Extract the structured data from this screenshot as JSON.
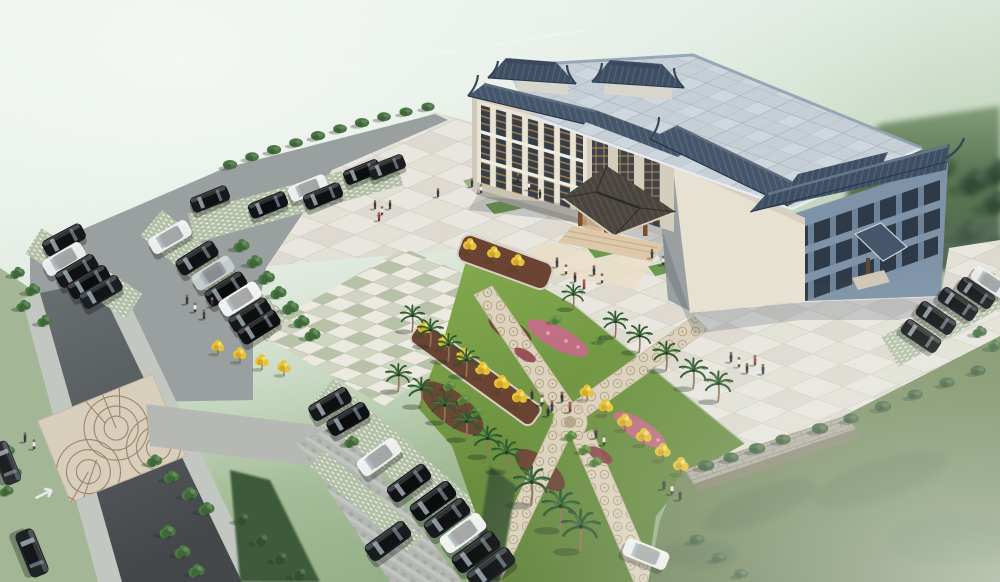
{
  "scene": {
    "type": "architectural-aerial-rendering",
    "subject": "chinese-style-civic-building-with-plaza-gardens-and-parking",
    "view": "birds-eye-perspective",
    "atmosphere": "foggy-top-left-and-bottom-right"
  },
  "palette": {
    "fog": "#f0f5f0",
    "grass_bg": "#a9bf9c",
    "tree_dark": "#3c5a40",
    "plaza": "#e9e6e0",
    "plaza_line": "#d2cec6",
    "plaza_dark": "#ded9d1",
    "checker_green": "#b7c2a8",
    "checker_light": "#ece9e0",
    "asphalt": "#9aa0a0",
    "aisle": "#b5b8b2",
    "road": "#565c5e",
    "sidewalk": "#c3c7c1",
    "stall": "#b3bfa6",
    "stall_dot": "#eef0e7",
    "lawn": "#7e9465",
    "garden_lawn": "#7aa446",
    "mulch": "#6a4333",
    "path": "#dcd2bd",
    "path_motif": "#b5a384",
    "roof_tile": "#46566a",
    "roof_ridge": "#6e7e92",
    "roof_flat": "#c6cfd6",
    "roof_line": "#a9b4bd",
    "wall": "#e9e3d4",
    "wall_shade": "#d4ccbc",
    "wall_blue": "#7e93a7",
    "window_dark": "#313b46",
    "lattice": "#c08845",
    "canopy": "#4a463f",
    "canopy_trim": "#d8cdb8",
    "wood": "#7c4e28",
    "glow": "#c98f4f",
    "step": "#ddc9a9",
    "stone_wall": "#b2ada2",
    "flower_pink": "#c96a8a",
    "ytree": "#e6c235",
    "palm": "#2d5830",
    "shrub": "#4a7444",
    "shadow": "#2c3e55"
  },
  "building": {
    "style": "traditional-chinese-roofs-on-modern-block",
    "floors": 3,
    "rooftop_pavilions": 2,
    "entrance_canopy": "hip-roof-porte-cochere",
    "secondary_canopy": 1
  },
  "counts": {
    "cars": 36,
    "palms": 19,
    "people": 33,
    "yellow_trees": 19
  },
  "darktrees": [
    [
      872,
      175,
      0,
      1.8
    ],
    [
      905,
      160,
      0,
      2.0
    ],
    [
      940,
      170,
      0,
      2.1
    ],
    [
      975,
      185,
      0,
      2.0
    ],
    [
      998,
      205,
      0,
      1.9
    ],
    [
      890,
      215,
      0,
      1.8
    ],
    [
      930,
      225,
      0,
      1.9
    ],
    [
      970,
      235,
      0,
      1.8
    ],
    [
      996,
      250,
      0,
      1.7
    ],
    [
      858,
      240,
      0,
      1.5
    ],
    [
      1000,
      175,
      0,
      2.0
    ]
  ],
  "trees": [
    [
      242,
      247,
      0,
      1.0
    ],
    [
      255,
      263,
      0,
      1.0
    ],
    [
      267,
      279,
      0,
      1.05
    ],
    [
      279,
      294,
      0,
      1.0
    ],
    [
      291,
      309,
      0,
      1.05
    ],
    [
      302,
      323,
      0,
      1.0
    ],
    [
      313,
      336,
      0,
      1.0
    ],
    [
      18,
      274,
      0,
      0.9
    ],
    [
      33,
      291,
      0,
      0.95
    ],
    [
      24,
      307,
      0,
      0.9
    ],
    [
      45,
      322,
      0,
      0.9
    ],
    [
      8,
      452,
      0,
      0.9
    ],
    [
      15,
      474,
      0,
      0.9
    ],
    [
      7,
      492,
      0,
      0.85
    ],
    [
      155,
      462,
      0,
      0.95
    ],
    [
      172,
      478,
      0,
      0.95
    ],
    [
      190,
      495,
      0,
      1.0
    ],
    [
      207,
      510,
      0,
      1.0
    ],
    [
      168,
      533,
      0,
      1.0
    ],
    [
      183,
      553,
      0,
      1.0
    ],
    [
      197,
      572,
      0,
      1.0
    ],
    [
      243,
      520,
      0,
      0.95,
      "#3f5f3a"
    ],
    [
      262,
      541,
      0,
      1.0,
      "#3f5f3a"
    ],
    [
      281,
      559,
      0,
      1.0,
      "#3f5f3a"
    ],
    [
      300,
      575,
      0,
      1.0,
      "#3f5f3a"
    ],
    [
      338,
      428,
      0,
      0.9
    ],
    [
      352,
      443,
      0,
      0.9
    ],
    [
      980,
      333,
      0,
      0.9,
      "#4f7d49"
    ],
    [
      995,
      347,
      0,
      0.9,
      "#4f7d49"
    ],
    [
      450,
      387,
      0,
      0.8,
      "#5f9140"
    ],
    [
      464,
      401,
      0,
      0.8,
      "#5f9140"
    ],
    [
      477,
      413,
      0,
      0.8,
      "#5f9140"
    ],
    [
      571,
      437,
      0,
      0.8,
      "#5f9140"
    ],
    [
      585,
      451,
      0,
      0.8,
      "#5f9140"
    ],
    [
      596,
      463,
      0,
      0.8,
      "#5f9140"
    ],
    [
      556,
      321,
      0,
      0.7,
      "#5f9140"
    ],
    [
      601,
      341,
      0,
      0.7,
      "#5f9140"
    ]
  ],
  "shrubs": [
    [
      230,
      166,
      0,
      1.3
    ],
    [
      252,
      158,
      0,
      1.25
    ],
    [
      274,
      151,
      0,
      1.3
    ],
    [
      296,
      144,
      0,
      1.25
    ],
    [
      318,
      137,
      0,
      1.3
    ],
    [
      340,
      130,
      0,
      1.25
    ],
    [
      362,
      124,
      0,
      1.3
    ],
    [
      384,
      118,
      0,
      1.25
    ],
    [
      406,
      113,
      0,
      1.2
    ],
    [
      428,
      108,
      0,
      1.2
    ],
    [
      706,
      467,
      0,
      1.5,
      "#45663e"
    ],
    [
      731,
      459,
      0,
      1.4,
      "#45663e"
    ],
    [
      757,
      450,
      0,
      1.5,
      "#45663e"
    ],
    [
      783,
      441,
      0,
      1.4,
      "#45663e"
    ],
    [
      820,
      430,
      0,
      1.5,
      "#45663e"
    ],
    [
      851,
      420,
      0,
      1.4,
      "#45663e"
    ],
    [
      883,
      408,
      0,
      1.5,
      "#45663e"
    ],
    [
      915,
      396,
      0,
      1.4,
      "#45663e"
    ],
    [
      947,
      384,
      0,
      1.4,
      "#45663e"
    ],
    [
      978,
      372,
      0,
      1.4,
      "#45663e"
    ],
    [
      697,
      541,
      0,
      1.4,
      "#43633c"
    ],
    [
      719,
      559,
      0,
      1.4,
      "#43633c"
    ],
    [
      741,
      575,
      0,
      1.3,
      "#43633c"
    ]
  ],
  "palms": [
    [
      412,
      330,
      0,
      0.95
    ],
    [
      430,
      345,
      0,
      1.0
    ],
    [
      448,
      360,
      0,
      1.0
    ],
    [
      466,
      375,
      0,
      1.0
    ],
    [
      398,
      390,
      0,
      1.0
    ],
    [
      421,
      405,
      0,
      1.05
    ],
    [
      444,
      421,
      0,
      1.05
    ],
    [
      466,
      438,
      0,
      1.1
    ],
    [
      487,
      455,
      0,
      1.1
    ],
    [
      506,
      470,
      0,
      1.15
    ],
    [
      531,
      503,
      0,
      1.4
    ],
    [
      560,
      528,
      0,
      1.45
    ],
    [
      580,
      549,
      0,
      1.5
    ],
    [
      573,
      308,
      0,
      0.9
    ],
    [
      615,
      336,
      0,
      0.95
    ],
    [
      639,
      351,
      0,
      1.0
    ],
    [
      666,
      369,
      0,
      1.05
    ],
    [
      693,
      387,
      0,
      1.1
    ],
    [
      718,
      400,
      0,
      1.1
    ]
  ],
  "ytrees": [
    [
      425,
      335,
      0,
      1.0
    ],
    [
      445,
      349,
      0,
      1.0
    ],
    [
      464,
      363,
      0,
      1.05
    ],
    [
      483,
      377,
      0,
      1.05
    ],
    [
      502,
      391,
      0,
      1.1
    ],
    [
      520,
      405,
      0,
      1.1
    ],
    [
      470,
      252,
      0,
      0.95
    ],
    [
      494,
      260,
      0,
      0.95
    ],
    [
      518,
      268,
      0,
      0.95
    ],
    [
      587,
      399,
      0,
      1.0
    ],
    [
      606,
      414,
      0,
      1.05
    ],
    [
      625,
      429,
      0,
      1.05
    ],
    [
      644,
      444,
      0,
      1.1
    ],
    [
      663,
      459,
      0,
      1.1
    ],
    [
      681,
      473,
      0,
      1.1
    ],
    [
      218,
      353,
      0,
      0.9
    ],
    [
      240,
      361,
      0,
      0.95
    ],
    [
      262,
      368,
      0,
      0.95
    ],
    [
      284,
      374,
      0,
      0.95
    ]
  ],
  "cars": [
    [
      64,
      240,
      -28,
      1.0,
      "#17191c"
    ],
    [
      64,
      259,
      -30,
      1.0,
      "#e9ebea"
    ],
    [
      77,
      271,
      -30,
      1.0,
      "#15171a"
    ],
    [
      89,
      282,
      -30,
      1.0,
      "#101215"
    ],
    [
      101,
      292,
      -30,
      1.0,
      "#1b1e22"
    ],
    [
      170,
      237,
      -30,
      1.0,
      "#eceeed"
    ],
    [
      197,
      258,
      -32,
      1.0,
      "#14161a"
    ],
    [
      213,
      273,
      -32,
      1.0,
      "#c6cbcd"
    ],
    [
      226,
      289,
      -32,
      1.0,
      "#0f1114"
    ],
    [
      240,
      299,
      -32,
      1.0,
      "#f0f1f0"
    ],
    [
      250,
      315,
      -32,
      1.0,
      "#131619"
    ],
    [
      259,
      327,
      -32,
      1.0,
      "#0e1013"
    ],
    [
      210,
      199,
      -22,
      0.9,
      "#17191d"
    ],
    [
      268,
      205,
      -22,
      0.9,
      "#101317"
    ],
    [
      308,
      188,
      -22,
      0.9,
      "#eceeed"
    ],
    [
      323,
      196,
      -22,
      0.9,
      "#14171a"
    ],
    [
      362,
      172,
      -22,
      0.85,
      "#101316"
    ],
    [
      387,
      167,
      -22,
      0.85,
      "#1a1d21"
    ],
    [
      32,
      553,
      68,
      1.1,
      "#1e2225"
    ],
    [
      6,
      463,
      68,
      1.0,
      "#2a2e33"
    ],
    [
      330,
      404,
      -30,
      1.0,
      "#141619"
    ],
    [
      348,
      419,
      -30,
      1.0,
      "#0f1215"
    ],
    [
      379,
      457,
      -36,
      1.05,
      "#edefee"
    ],
    [
      409,
      483,
      -36,
      1.05,
      "#111316"
    ],
    [
      433,
      501,
      -36,
      1.1,
      "#0e1114"
    ],
    [
      447,
      518,
      -36,
      1.1,
      "#16181c"
    ],
    [
      463,
      533,
      -36,
      1.1,
      "#eff0ef"
    ],
    [
      476,
      552,
      -36,
      1.15,
      "#101215"
    ],
    [
      491,
      568,
      -36,
      1.15,
      "#14161a"
    ],
    [
      388,
      541,
      -36,
      1.1,
      "#181b1f"
    ],
    [
      646,
      554,
      22,
      1.05,
      "#f0f1f0"
    ],
    [
      921,
      336,
      34,
      0.95,
      "#101215"
    ],
    [
      936,
      318,
      34,
      0.95,
      "#0d0f12"
    ],
    [
      958,
      304,
      34,
      0.95,
      "#14161a"
    ],
    [
      976,
      293,
      34,
      0.9,
      "#191c20"
    ],
    [
      990,
      282,
      34,
      0.9,
      "#e9ebeb"
    ]
  ],
  "people": [
    [
      557,
      266,
      0,
      1.1,
      "#3a4350"
    ],
    [
      566,
      273,
      0,
      1.1,
      "#eceff1"
    ],
    [
      575,
      281,
      0,
      1.1,
      "#44332c"
    ],
    [
      584,
      288,
      0,
      1.1,
      "#c0463c"
    ],
    [
      594,
      274,
      0,
      1.1,
      "#333f4c"
    ],
    [
      602,
      282,
      0,
      1.1,
      "#e6e8e9"
    ],
    [
      652,
      257,
      0,
      1.05,
      "#39424e"
    ],
    [
      663,
      264,
      0,
      1.05,
      "#e2e5e7"
    ],
    [
      375,
      208,
      0,
      1.0,
      "#323845"
    ],
    [
      382,
      214,
      0,
      1.0,
      "#e9eaea"
    ],
    [
      390,
      208,
      0,
      1.0,
      "#423530"
    ],
    [
      379,
      220,
      0,
      1.0,
      "#aa3a33"
    ],
    [
      438,
      196,
      0,
      1.0,
      "#333a46"
    ],
    [
      472,
      186,
      0,
      1.0,
      "#313d49"
    ],
    [
      481,
      192,
      0,
      1.0,
      "#e8e9e9"
    ],
    [
      518,
      181,
      0,
      1.0,
      "#39424e"
    ],
    [
      529,
      189,
      0,
      1.0,
      "#eaebeb"
    ],
    [
      540,
      197,
      0,
      1.0,
      "#3b2f2a"
    ],
    [
      731,
      361,
      0,
      1.15,
      "#323c49"
    ],
    [
      739,
      366,
      0,
      1.15,
      "#ededed"
    ],
    [
      747,
      372,
      0,
      1.15,
      "#3e3029"
    ],
    [
      755,
      364,
      0,
      1.15,
      "#b5443b"
    ],
    [
      763,
      373,
      0,
      1.15,
      "#343e4b"
    ],
    [
      532,
      398,
      0,
      1.2,
      "#353f4b"
    ],
    [
      542,
      404,
      0,
      1.2,
      "#eaebec"
    ],
    [
      552,
      410,
      0,
      1.2,
      "#39434f"
    ],
    [
      562,
      401,
      0,
      1.2,
      "#3c2e28"
    ],
    [
      570,
      411,
      0,
      1.2,
      "#b2423a"
    ],
    [
      548,
      415,
      0,
      1.2,
      "#2f3a46"
    ],
    [
      596,
      437,
      0,
      1.2,
      "#333c48"
    ],
    [
      604,
      444,
      0,
      1.2,
      "#e9eaea"
    ],
    [
      664,
      488,
      0,
      1.25,
      "#2f3844"
    ],
    [
      672,
      493,
      0,
      1.25,
      "#e8e9e9"
    ],
    [
      680,
      499,
      0,
      1.25,
      "#363636"
    ],
    [
      187,
      303,
      0,
      1.1,
      "#323b47"
    ],
    [
      195,
      311,
      0,
      1.1,
      "#eaebeb"
    ],
    [
      204,
      318,
      0,
      1.1,
      "#3a434f"
    ],
    [
      212,
      306,
      0,
      1.1,
      "#3d2f29"
    ],
    [
      25,
      441,
      0,
      1.1,
      "#343d49"
    ],
    [
      34,
      448,
      0,
      1.1,
      "#e7e8e9"
    ]
  ]
}
